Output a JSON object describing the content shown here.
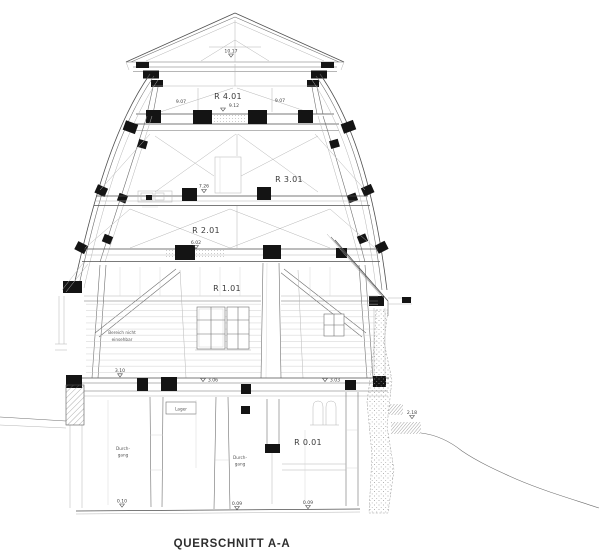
{
  "title": "QUERSCHNITT A-A",
  "rooms": {
    "r401": "R 4.01",
    "r301": "R 3.01",
    "r201": "R 2.01",
    "r101": "R 1.01",
    "r001": "R 0.01"
  },
  "dimensions": {
    "roof_apex": "10.17",
    "level4_left": "9.07",
    "level4_center": "9.12",
    "level4_right": "9.07",
    "level3": "7.26",
    "level2": "6.02",
    "ground_left": "3.10",
    "ground_center": "3.06",
    "ground_right": "3.03",
    "terrain_right": "2.18",
    "base_left": "0.10",
    "base_center": "0.09",
    "base_right": "0.09"
  },
  "annotations": {
    "not_visible_1": "Bereich nicht",
    "not_visible_2": "einsehbar",
    "storage": "Lager",
    "passage1_1": "Durch-",
    "passage1_2": "gang",
    "passage2_1": "Durch-",
    "passage2_2": "gang"
  },
  "colors": {
    "background": "#ffffff",
    "line_dark": "#4f4f4f",
    "line_mid": "#6f6f6f",
    "line_light": "#b5b5b5",
    "black_fill": "#141414",
    "text": "#2e2e2e"
  }
}
